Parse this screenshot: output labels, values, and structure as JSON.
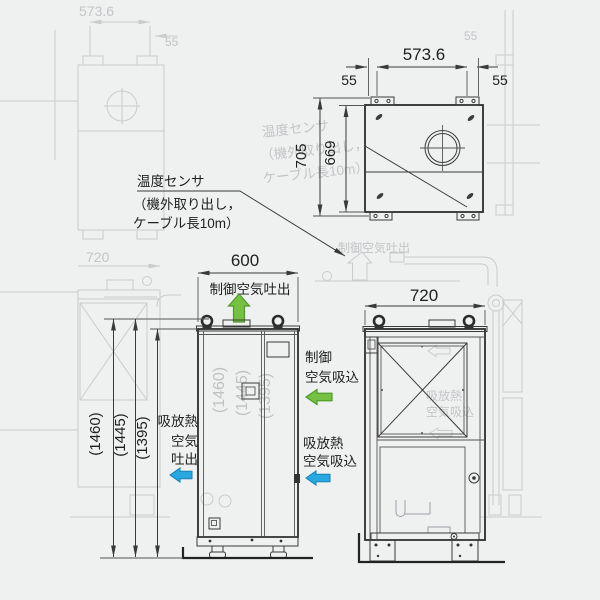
{
  "colors": {
    "background": "#eff0f0",
    "line": "#3a3a3a",
    "ghost": "#c9cccd",
    "green": "#76c043",
    "green_dark": "#4c9a2a",
    "blue": "#29a7e0",
    "blue_dark": "#1581b5"
  },
  "top_view": {
    "width": "573.6",
    "foot_offset_left": "55",
    "foot_offset_right": "55",
    "depth_overall": "705",
    "depth_inner": "669"
  },
  "sensor_note": {
    "line1": "温度センサ",
    "line2": "（機外取り出し，",
    "line3": "ケーブル長10m）"
  },
  "front_view": {
    "width": "600",
    "control_air_out": "制御空気吐出",
    "control_air_in_1": "制御",
    "control_air_in_2": "空気吸込",
    "heat_air_out_1": "吸放熱",
    "heat_air_out_2": "空気",
    "heat_air_out_3": "吐出",
    "heat_air_in_1": "吸放熱",
    "heat_air_in_2": "空気吸込",
    "heights": [
      "(1460)",
      "(1445)",
      "(1395)"
    ]
  },
  "side_view": {
    "width": "720"
  },
  "ghost": {
    "top_width": "573.6",
    "foot_offset": "55",
    "side_width": "720",
    "control_air_out": "制御空気吐出",
    "sensor_line1": "温度センサ",
    "sensor_line2": "（機外取り出し，",
    "sensor_line3": "ケーブル長10m）",
    "heights": [
      "(1460)",
      "(1445)",
      "(1395)"
    ],
    "heat_in_1": "吸放熱",
    "heat_in_2": "空気吸込"
  }
}
